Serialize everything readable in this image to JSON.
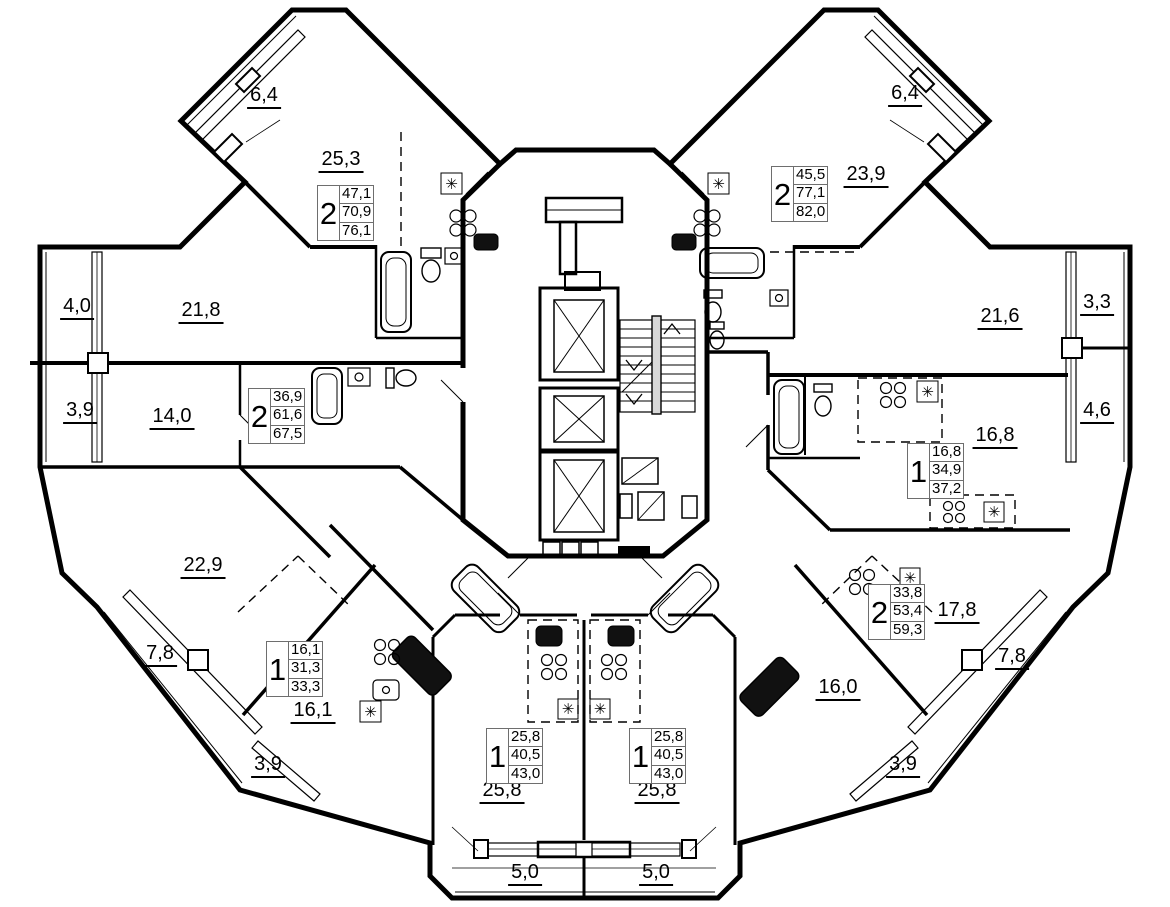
{
  "plan": {
    "colors": {
      "wall": "#000000",
      "background": "#ffffff",
      "stamp_border": "#6e6e6e"
    },
    "icons": {
      "fridge": "✳"
    },
    "stamps": [
      {
        "id": "top-left",
        "rooms": "2",
        "living_area": "47,1",
        "floor_area": "70,9",
        "total_area": "76,1"
      },
      {
        "id": "top-right",
        "rooms": "2",
        "living_area": "45,5",
        "floor_area": "77,1",
        "total_area": "82,0"
      },
      {
        "id": "left",
        "rooms": "2",
        "living_area": "36,9",
        "floor_area": "61,6",
        "total_area": "67,5"
      },
      {
        "id": "right",
        "rooms": "1",
        "living_area": "16,8",
        "floor_area": "34,9",
        "total_area": "37,2"
      },
      {
        "id": "lower-left",
        "rooms": "1",
        "living_area": "16,1",
        "floor_area": "31,3",
        "total_area": "33,3"
      },
      {
        "id": "bottom-left",
        "rooms": "1",
        "living_area": "25,8",
        "floor_area": "40,5",
        "total_area": "43,0"
      },
      {
        "id": "bottom-right",
        "rooms": "1",
        "living_area": "25,8",
        "floor_area": "40,5",
        "total_area": "43,0"
      },
      {
        "id": "lower-right",
        "rooms": "2",
        "living_area": "33,8",
        "floor_area": "53,4",
        "total_area": "59,3"
      }
    ],
    "room_labels": [
      {
        "id": "balcony-top-left",
        "text": "6,4"
      },
      {
        "id": "room-top-left",
        "text": "25,3"
      },
      {
        "id": "balcony-top-right",
        "text": "6,4"
      },
      {
        "id": "room-top-right",
        "text": "23,9"
      },
      {
        "id": "balcony-left-upper",
        "text": "4,0"
      },
      {
        "id": "room-left-upper",
        "text": "21,8"
      },
      {
        "id": "balcony-left-lower",
        "text": "3,9"
      },
      {
        "id": "room-left-lower",
        "text": "14,0"
      },
      {
        "id": "room-right-upper",
        "text": "21,6"
      },
      {
        "id": "balcony-right-upper",
        "text": "3,3"
      },
      {
        "id": "balcony-right-lower",
        "text": "4,6"
      },
      {
        "id": "room-right-lower",
        "text": "16,8"
      },
      {
        "id": "room-lower-left",
        "text": "22,9"
      },
      {
        "id": "balcony-lower-left",
        "text": "7,8"
      },
      {
        "id": "room-lower-left-2",
        "text": "16,1"
      },
      {
        "id": "balcony-lower-left-2",
        "text": "3,9"
      },
      {
        "id": "room-bottom-left",
        "text": "25,8"
      },
      {
        "id": "room-bottom-right",
        "text": "25,8"
      },
      {
        "id": "balcony-bottom-left",
        "text": "5,0"
      },
      {
        "id": "balcony-bottom-right",
        "text": "5,0"
      },
      {
        "id": "room-lower-right",
        "text": "17,8"
      },
      {
        "id": "balcony-lower-right",
        "text": "7,8"
      },
      {
        "id": "room-lower-right-2",
        "text": "16,0"
      },
      {
        "id": "balcony-lower-right-2",
        "text": "3,9"
      }
    ]
  }
}
